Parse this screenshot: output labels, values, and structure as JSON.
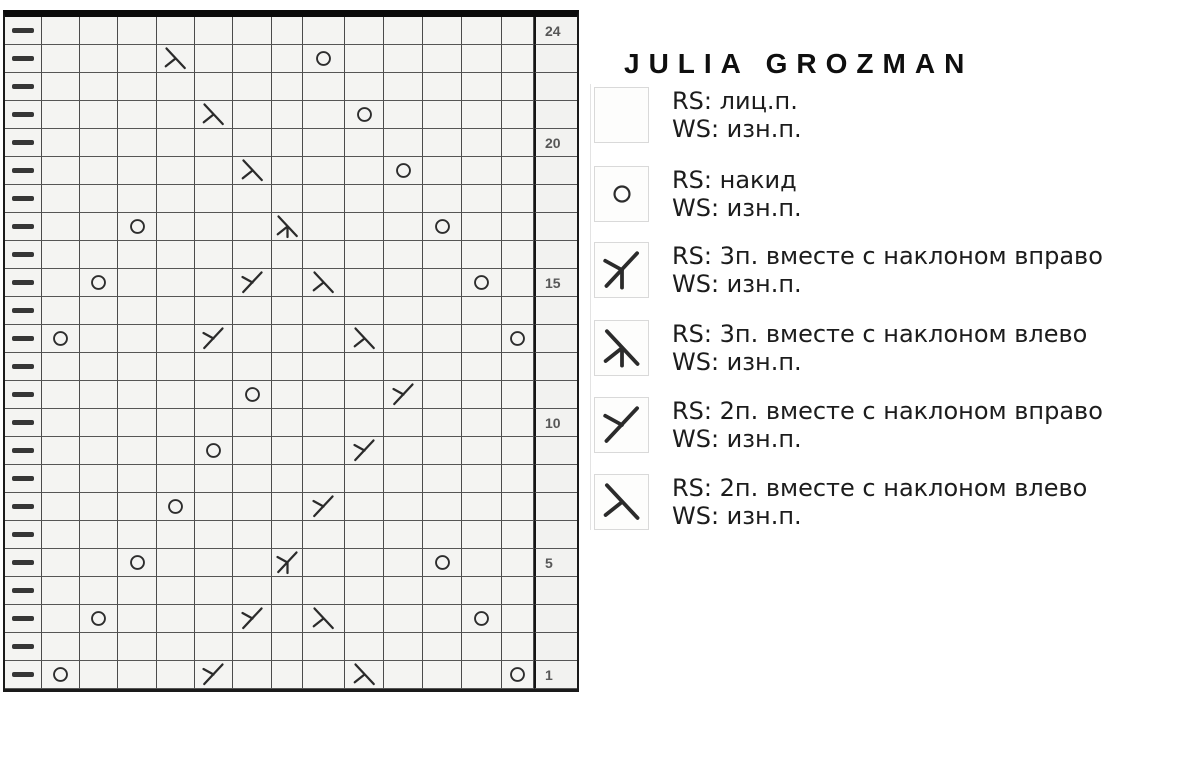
{
  "page": {
    "title": "JULIA GROZMAN"
  },
  "chart_data": {
    "type": "table",
    "description": "Lace knitting chart, 24 rows; leftmost column = edge purl dashes; right column = row numbers",
    "columns": 14,
    "row_numbers_shown": [
      "24",
      "20",
      "15",
      "10",
      "5",
      "1"
    ],
    "symbol_key": {
      "dash": "purl edge stitch",
      "yo": "yarn over (накид)",
      "dec2R": "2 together right slant",
      "dec2L": "2 together left slant",
      "dec3R": "3 together right slant",
      "dec3L": "3 together left slant"
    },
    "rows": [
      {
        "row": 24,
        "label": "24",
        "cells": [
          "dash",
          "",
          "",
          "",
          "",
          "",
          "",
          "",
          "",
          "",
          "",
          "",
          "",
          ""
        ]
      },
      {
        "row": 23,
        "label": "",
        "cells": [
          "dash",
          "",
          "",
          "",
          "dec2L",
          "",
          "",
          "",
          "yo",
          "",
          "",
          "",
          "",
          ""
        ]
      },
      {
        "row": 22,
        "label": "",
        "cells": [
          "dash",
          "",
          "",
          "",
          "",
          "",
          "",
          "",
          "",
          "",
          "",
          "",
          "",
          ""
        ]
      },
      {
        "row": 21,
        "label": "",
        "cells": [
          "dash",
          "",
          "",
          "",
          "",
          "dec2L",
          "",
          "",
          "",
          "yo",
          "",
          "",
          "",
          ""
        ]
      },
      {
        "row": 20,
        "label": "20",
        "cells": [
          "dash",
          "",
          "",
          "",
          "",
          "",
          "",
          "",
          "",
          "",
          "",
          "",
          "",
          ""
        ]
      },
      {
        "row": 19,
        "label": "",
        "cells": [
          "dash",
          "",
          "",
          "",
          "",
          "",
          "dec2L",
          "",
          "",
          "",
          "yo",
          "",
          "",
          ""
        ]
      },
      {
        "row": 18,
        "label": "",
        "cells": [
          "dash",
          "",
          "",
          "",
          "",
          "",
          "",
          "",
          "",
          "",
          "",
          "",
          "",
          ""
        ]
      },
      {
        "row": 17,
        "label": "",
        "cells": [
          "dash",
          "",
          "",
          "yo",
          "",
          "",
          "",
          "dec3L",
          "",
          "",
          "",
          "yo",
          "",
          ""
        ]
      },
      {
        "row": 16,
        "label": "",
        "cells": [
          "dash",
          "",
          "",
          "",
          "",
          "",
          "",
          "",
          "",
          "",
          "",
          "",
          "",
          ""
        ]
      },
      {
        "row": 15,
        "label": "15",
        "cells": [
          "dash",
          "",
          "yo",
          "",
          "",
          "",
          "dec2R",
          "",
          "dec2L",
          "",
          "",
          "",
          "yo",
          ""
        ]
      },
      {
        "row": 14,
        "label": "",
        "cells": [
          "dash",
          "",
          "",
          "",
          "",
          "",
          "",
          "",
          "",
          "",
          "",
          "",
          "",
          ""
        ]
      },
      {
        "row": 13,
        "label": "",
        "cells": [
          "dash",
          "yo",
          "",
          "",
          "",
          "dec2R",
          "",
          "",
          "",
          "dec2L",
          "",
          "",
          "",
          "yo"
        ]
      },
      {
        "row": 12,
        "label": "",
        "cells": [
          "dash",
          "",
          "",
          "",
          "",
          "",
          "",
          "",
          "",
          "",
          "",
          "",
          "",
          ""
        ]
      },
      {
        "row": 11,
        "label": "",
        "cells": [
          "dash",
          "",
          "",
          "",
          "",
          "",
          "yo",
          "",
          "",
          "",
          "dec2R",
          "",
          "",
          ""
        ]
      },
      {
        "row": 10,
        "label": "10",
        "cells": [
          "dash",
          "",
          "",
          "",
          "",
          "",
          "",
          "",
          "",
          "",
          "",
          "",
          "",
          ""
        ]
      },
      {
        "row": 9,
        "label": "",
        "cells": [
          "dash",
          "",
          "",
          "",
          "",
          "yo",
          "",
          "",
          "",
          "dec2R",
          "",
          "",
          "",
          ""
        ]
      },
      {
        "row": 8,
        "label": "",
        "cells": [
          "dash",
          "",
          "",
          "",
          "",
          "",
          "",
          "",
          "",
          "",
          "",
          "",
          "",
          ""
        ]
      },
      {
        "row": 7,
        "label": "",
        "cells": [
          "dash",
          "",
          "",
          "",
          "yo",
          "",
          "",
          "",
          "dec2R",
          "",
          "",
          "",
          "",
          ""
        ]
      },
      {
        "row": 6,
        "label": "",
        "cells": [
          "dash",
          "",
          "",
          "",
          "",
          "",
          "",
          "",
          "",
          "",
          "",
          "",
          "",
          ""
        ]
      },
      {
        "row": 5,
        "label": "5",
        "cells": [
          "dash",
          "",
          "",
          "yo",
          "",
          "",
          "",
          "dec3R",
          "",
          "",
          "",
          "yo",
          "",
          ""
        ]
      },
      {
        "row": 4,
        "label": "",
        "cells": [
          "dash",
          "",
          "",
          "",
          "",
          "",
          "",
          "",
          "",
          "",
          "",
          "",
          "",
          ""
        ]
      },
      {
        "row": 3,
        "label": "",
        "cells": [
          "dash",
          "",
          "yo",
          "",
          "",
          "",
          "dec2R",
          "",
          "dec2L",
          "",
          "",
          "",
          "yo",
          ""
        ]
      },
      {
        "row": 2,
        "label": "",
        "cells": [
          "dash",
          "",
          "",
          "",
          "",
          "",
          "",
          "",
          "",
          "",
          "",
          "",
          "",
          ""
        ]
      },
      {
        "row": 1,
        "label": "1",
        "cells": [
          "dash",
          "yo",
          "",
          "",
          "",
          "dec2R",
          "",
          "",
          "",
          "dec2L",
          "",
          "",
          "",
          "yo"
        ]
      }
    ]
  },
  "legend": {
    "entries": [
      {
        "icon": "knit",
        "rs": "RS: лиц.п.",
        "ws": "WS: изн.п."
      },
      {
        "icon": "yo",
        "rs": "RS: накид",
        "ws": "WS: изн.п."
      },
      {
        "icon": "dec3R",
        "rs": "RS: 3п. вместе с наклоном вправо",
        "ws": "WS: изн.п."
      },
      {
        "icon": "dec3L",
        "rs": "RS: 3п. вместе с наклоном влево",
        "ws": "WS: изн.п."
      },
      {
        "icon": "dec2R",
        "rs": "RS: 2п. вместе с наклоном вправо",
        "ws": "WS: изн.п."
      },
      {
        "icon": "dec2L",
        "rs": "RS: 2п. вместе с наклоном влево",
        "ws": "WS: изн.п."
      }
    ]
  }
}
